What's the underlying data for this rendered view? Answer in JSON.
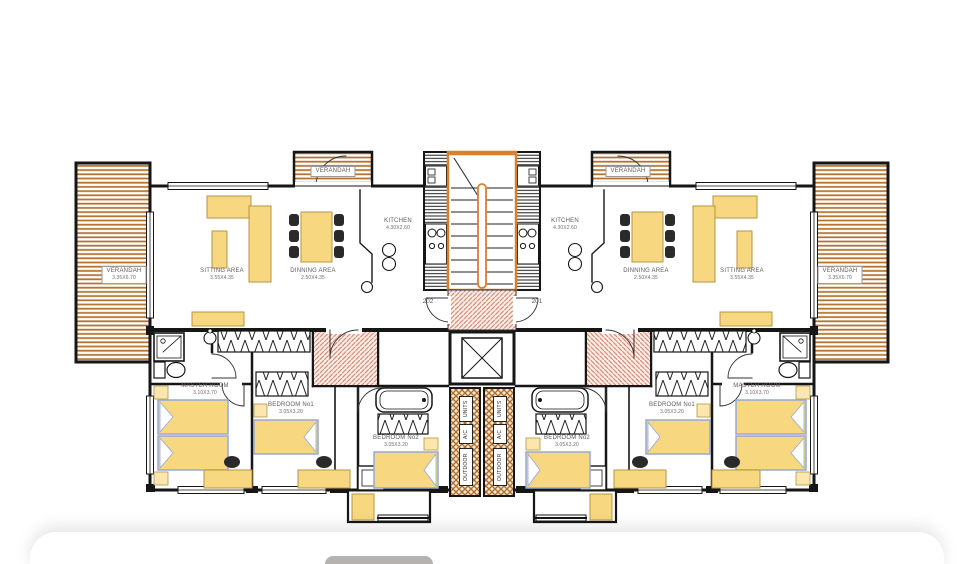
{
  "window": {
    "width": 974,
    "height": 564,
    "background": "#ffffff"
  },
  "plan": {
    "rooms": {
      "verandah": {
        "label": "VERANDAH",
        "dims": "3.35X6.70"
      },
      "verandah_top": {
        "label": "VERANDAH"
      },
      "sitting": {
        "label": "SITTING AREA",
        "dims": "3.55X4.35"
      },
      "dinning": {
        "label": "DINNING AREA",
        "dims": "2.50X4.35"
      },
      "kitchen": {
        "label": "KITCHEN",
        "dims": "4.30X2.60"
      },
      "master": {
        "label": "MASTER ROOM",
        "dims": "3.10X3.70"
      },
      "bedroom1": {
        "label": "BEDROOM No1",
        "dims": "3.05X3.20"
      },
      "bedroom2": {
        "label": "BEDROOM No2",
        "dims": "3.05X3.20"
      }
    },
    "doors": {
      "left_unit": "202",
      "right_unit": "201"
    },
    "ac_unit": {
      "top": "UNITS",
      "mid": "A/C",
      "bottom": "OUTDOOR"
    },
    "colors": {
      "wall": "#161616",
      "wood_stripe": "#b5742f",
      "stair_accent": "#d8802c",
      "furniture_yellow": "#f7d77f",
      "bed_outline": "#97a8d8",
      "pink_hatch": "#dd8e75",
      "label_text": "#5d5d5d",
      "pill": "#b6b2b0"
    }
  }
}
